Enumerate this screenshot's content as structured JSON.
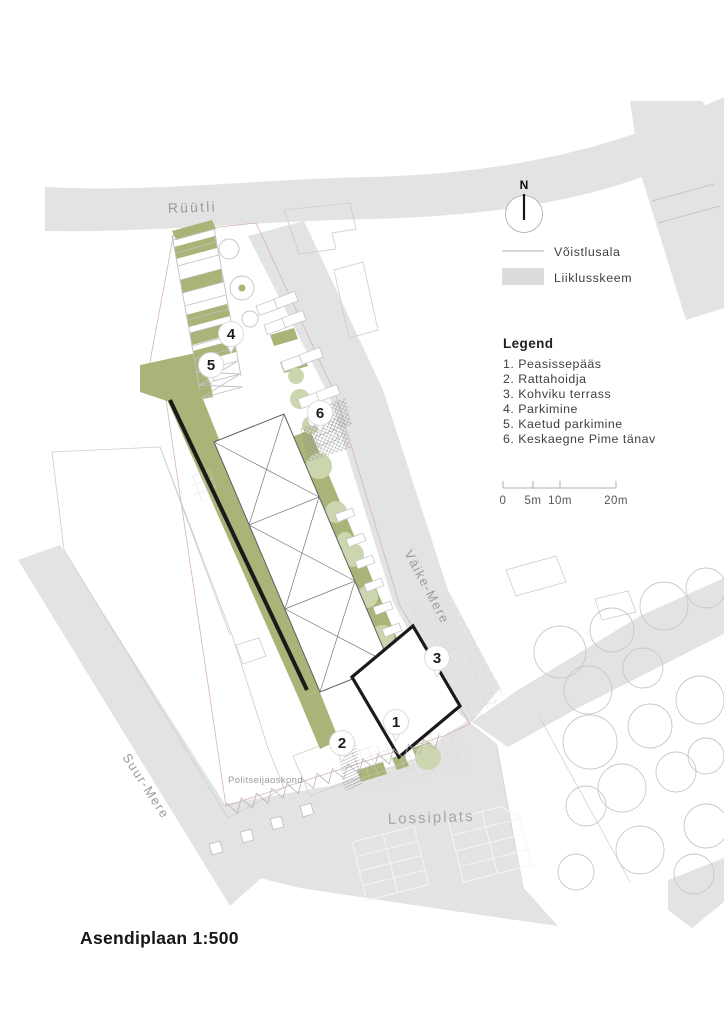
{
  "page": {
    "title": "Asendiplaan 1:500"
  },
  "north": {
    "label": "N"
  },
  "key": {
    "items": [
      {
        "label": "Võistlusala",
        "swatch": "line"
      },
      {
        "label": "Liiklusskeem",
        "swatch": "area"
      }
    ]
  },
  "legend": {
    "heading": "Legend",
    "items": [
      "1. Peasissepääs",
      "2. Rattahoidja",
      "3. Kohviku terrass",
      "4. Parkimine",
      "5. Kaetud parkimine",
      "6. Keskaegne Pime tänav"
    ]
  },
  "scalebar": {
    "labels": [
      "0",
      "5m",
      "10m",
      "20m"
    ]
  },
  "map": {
    "streets": {
      "ruutli": "Rüütli",
      "vaike_mere": "Väike-Mere",
      "suur_mere": "Suur-Mere",
      "lossiplats": "Lossiplats"
    },
    "buildings": {
      "politseijaoskond": "Politseijaoskond"
    },
    "markers": [
      "1",
      "2",
      "3",
      "4",
      "5",
      "6"
    ]
  },
  "colors": {
    "street_gray": "#e3e3e3",
    "site_green": "#a9b478",
    "tree_green": "#ccd6ae",
    "outline_black": "#1a1a1a",
    "boundary_pink": "#d8b2b2"
  }
}
